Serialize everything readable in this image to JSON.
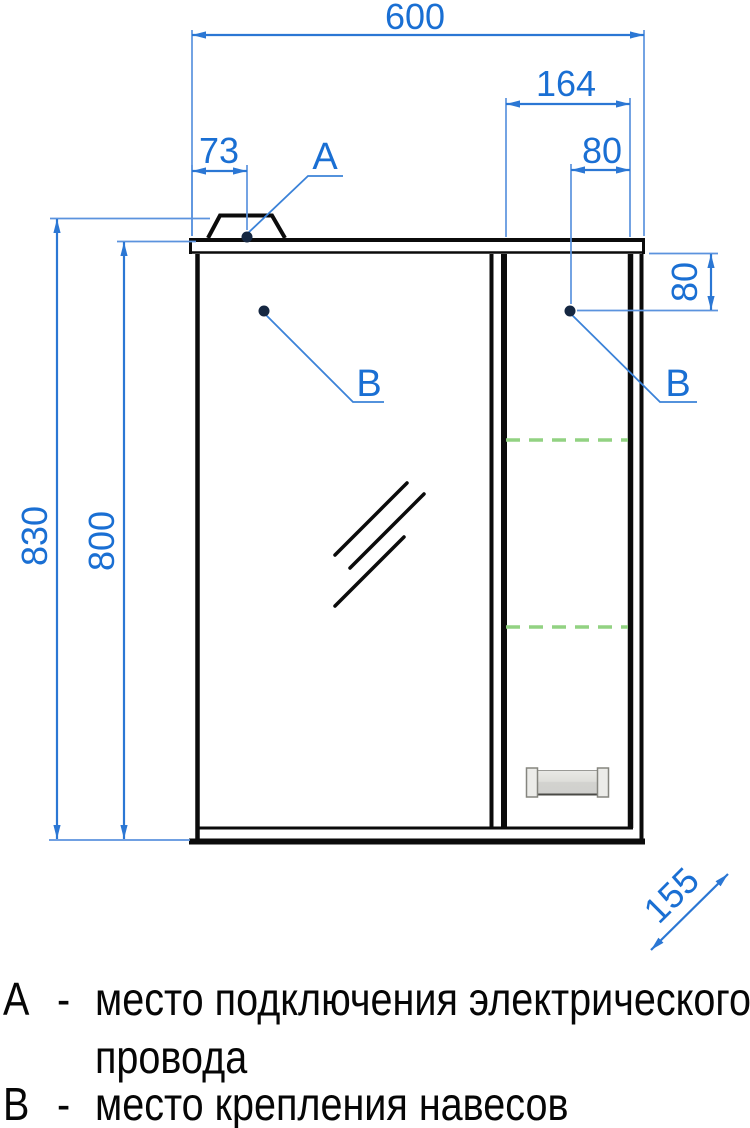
{
  "drawing": {
    "dims": {
      "total_width": "600",
      "right_section_width": "164",
      "top_hinge_offset": "80",
      "power_point_offset": "73",
      "total_height": "830",
      "cabinet_height": "800",
      "side_hinge_offset": "80",
      "depth": "155"
    },
    "labels": {
      "a": "А",
      "b_left": "В",
      "b_right": "В"
    },
    "colors": {
      "dimension_blue": "#2b77d4",
      "text_blue": "#1a6fd3",
      "shelf_green": "#92d282",
      "outline_black": "#0b0b0b",
      "marker_navy": "#152741"
    }
  },
  "legend": {
    "separator": "-",
    "item_a": {
      "key": "А",
      "line1": "место подключения электрического",
      "line2": "провода"
    },
    "item_b": {
      "key": "В",
      "text": "место крепления навесов"
    }
  }
}
